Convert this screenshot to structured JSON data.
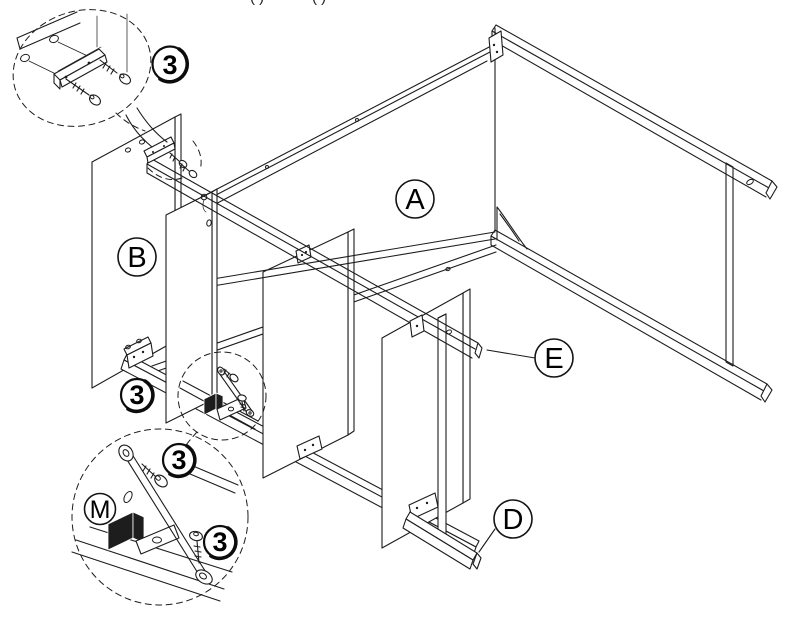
{
  "diagram": {
    "background": "#ffffff",
    "line_color": "#1c1c1c"
  },
  "part_labels": {
    "a": "A",
    "b": "B",
    "d": "D",
    "e": "E",
    "m": "M"
  },
  "hardware_callout": {
    "number": "3"
  },
  "cropped_top_text": {
    "left": "( )",
    "right": "( )"
  }
}
